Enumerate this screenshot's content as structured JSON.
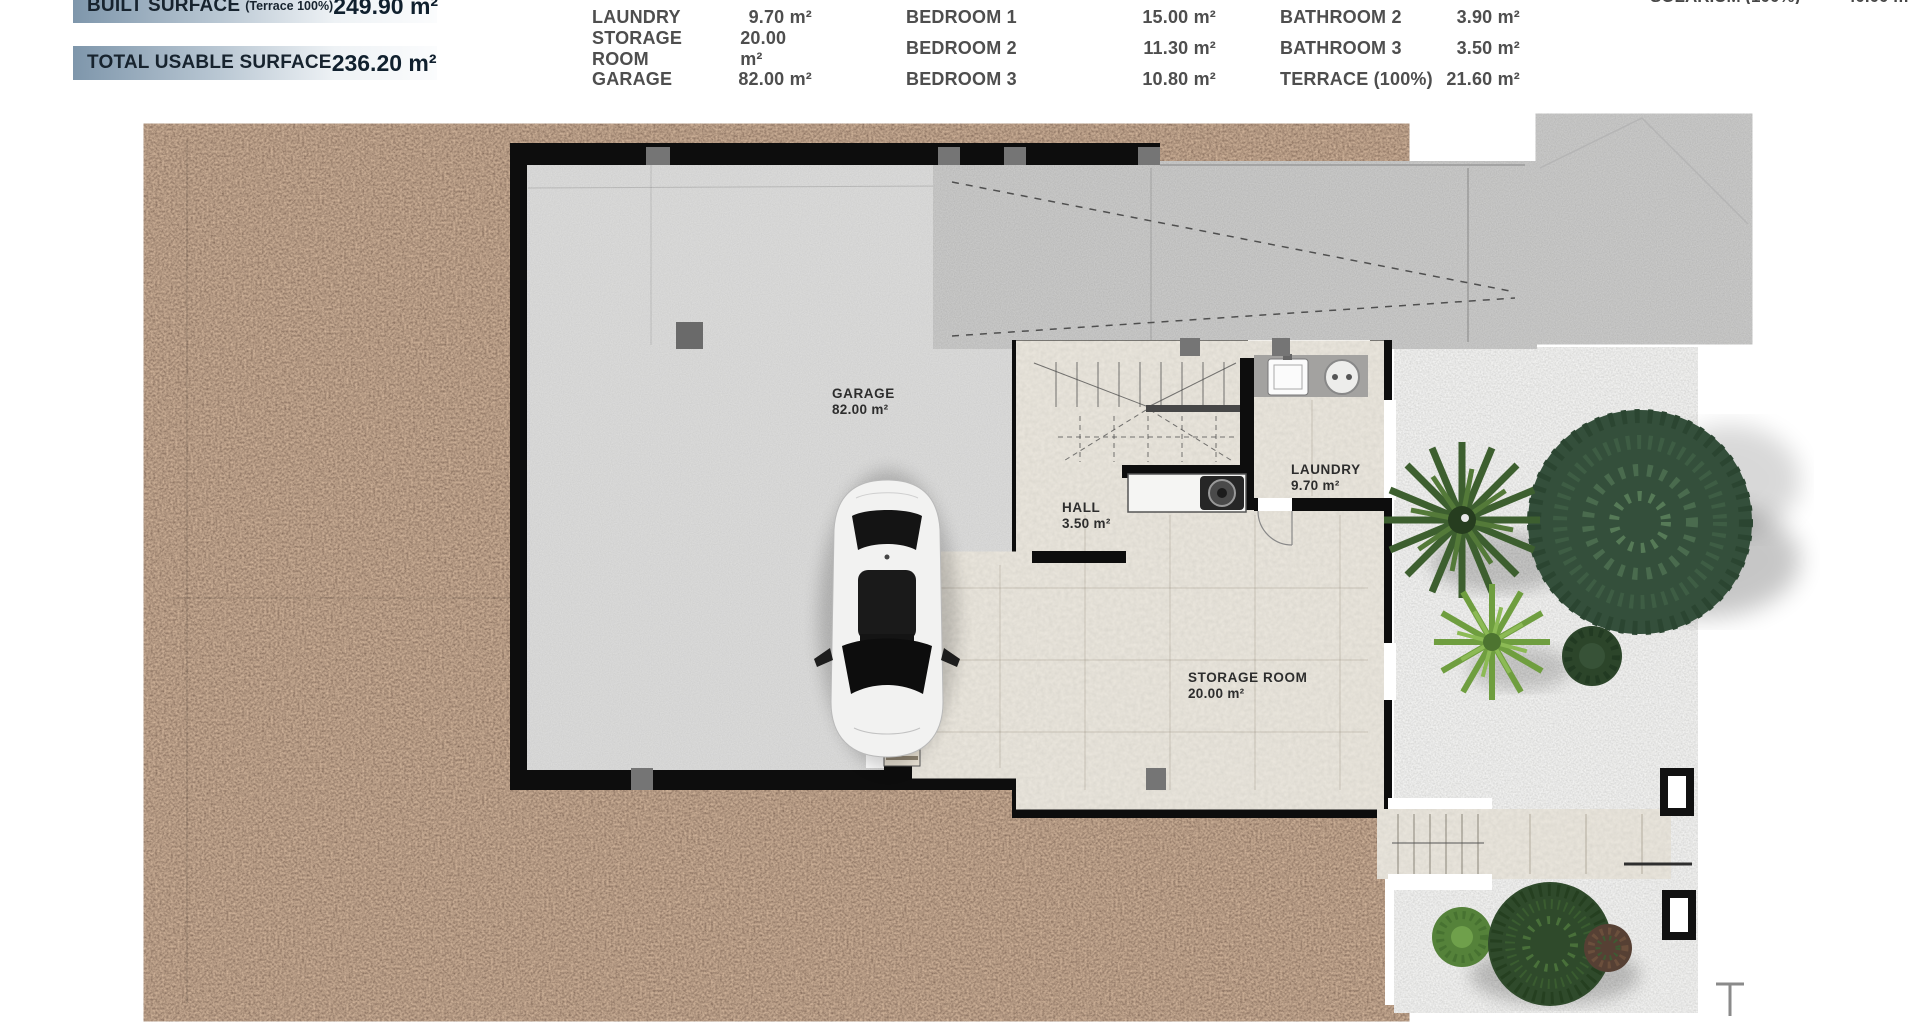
{
  "header": {
    "banners": [
      {
        "label": "BUILT SURFACE",
        "sublabel": "(Terrace 100%)",
        "value": "249.90 m²"
      },
      {
        "label": "TOTAL USABLE SURFACE",
        "sublabel": "",
        "value": "236.20 m²"
      }
    ],
    "partial_top_line": {
      "label": "SOLARIUM (100%)",
      "value": "40.00 m²"
    },
    "room_table": {
      "columns": [
        {
          "rows": [
            {
              "label": "LAUNDRY",
              "value": "9.70 m²"
            },
            {
              "label": "STORAGE ROOM",
              "value": "20.00 m²"
            },
            {
              "label": "GARAGE",
              "value": "82.00 m²"
            }
          ]
        },
        {
          "rows": [
            {
              "label": "BEDROOM 1",
              "value": "15.00 m²"
            },
            {
              "label": "BEDROOM 2",
              "value": "11.30 m²"
            },
            {
              "label": "BEDROOM 3",
              "value": "10.80 m²"
            }
          ]
        },
        {
          "rows": [
            {
              "label": "BATHROOM 2",
              "value": "3.90 m²"
            },
            {
              "label": "BATHROOM 3",
              "value": "3.50 m²"
            },
            {
              "label": "TERRACE (100%)",
              "value": "21.60 m²"
            }
          ]
        }
      ]
    }
  },
  "plan_labels": {
    "garage": {
      "name": "GARAGE",
      "area": "82.00 m²"
    },
    "hall": {
      "name": "HALL",
      "area": "3.50 m²"
    },
    "laundry": {
      "name": "LAUNDRY",
      "area": "9.70 m²"
    },
    "storage": {
      "name": "STORAGE ROOM",
      "area": "20.00 m²"
    }
  },
  "colors": {
    "banner_gradient_start": "#7e96ab",
    "banner_text": "#17232e",
    "table_text": "#4e4e4e",
    "wall_black": "#0d0d0d",
    "terrain_brown": "#70503a",
    "garage_floor": "#ababab",
    "ramp_gray": "#8a8a8a",
    "tile_beige": "#c4bcac",
    "garden_gravel": "#d5d5d3",
    "tree_green_dark": "#344f3b",
    "plant_green_bright": "#6f9e3f"
  }
}
